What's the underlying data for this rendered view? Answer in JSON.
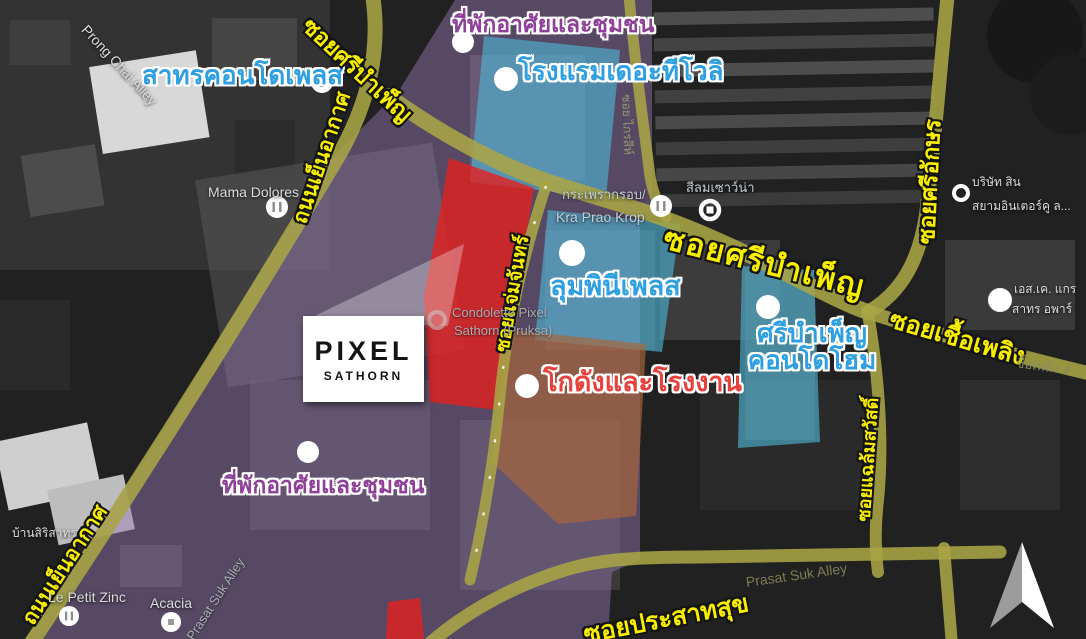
{
  "project_box": {
    "title": "PIXEL",
    "subtitle": "SATHORN"
  },
  "place_labels": {
    "sathorn_condo_place": "สาทรคอนโดเพลส",
    "residential_top": "ที่พักอาศัยและชุมชน",
    "tivoli_hotel": "โรงแรมเดอะทีโวลิ",
    "lumpini_place": "ลุมพินีเพลส",
    "sri_bamphen_condo_line1": "ศรีบำเพ็ญ",
    "sri_bamphen_condo_line2": "คอนโดโฮม",
    "warehouse_factory": "โกดังและโรงงาน",
    "residential_bottom": "ที่พักอาศัยและชุมชน"
  },
  "road_labels": {
    "sri_bamphen_nw": "ซอยศรีบำเพ็ญ",
    "sri_bamphen_e": "ซอยศรีบำเพ็ญ",
    "yen_akat_upper": "ถนนเย็นอากาศ",
    "yen_akat_lower": "ถนนเย็นอากาศ",
    "sri_akson": "ซอยศรีอักษร",
    "chuea_phloeng": "ซอยเชื้อเพลิง",
    "chaem_chan": "ซอยแจ่มจันทร์",
    "chalaem_sawat": "ซอยแฉล้มสวัสดิ์",
    "prasat_suk": "ซอยประสาทสุข"
  },
  "basemap_labels": {
    "prong_chai_alley": "Prong Chai Alley",
    "mama_dolores": "Mama Dolores",
    "kra_prao_line1": "กระเพรากรอบ/",
    "kra_prao_line2": "Kra Prao Krop",
    "silom_sauna": "สีลมเซาว์น่า",
    "company_line1": "บริษัท สิน",
    "company_line2": "สยามอินเตอร์คู ล...",
    "sk_line1": "เอส.เค. แกร",
    "sk_line2": "สาทร อพาร์",
    "chuea_phloeng_4": "ชื้อเพลิง 4",
    "baan_siri_sathorn": "บ้านสิริสาทร",
    "le_petit_zinc": "Le Petit Zinc",
    "acacia": "Acacia",
    "prasat_suk_alley_w": "Prasat Suk Alley",
    "prasat_suk_alley_e": "Prasat Suk Alley",
    "krai_si": "ซอย ไกรสีห์",
    "condolette_line1": "Condolette Pixel",
    "condolette_line2": "Sathorn (Pruksa)"
  },
  "colors": {
    "road_label_yellow": "#f8ef00",
    "condo_label_blue": "#2e9fe0",
    "residential_label_purple": "#8e3f98",
    "warehouse_label_red": "#e8403a",
    "zone_residential_purple": "#9a7ab5",
    "zone_condo_teal": "#4fb6d6",
    "zone_project_red": "#e3201e",
    "zone_warehouse_brown": "#a9663a",
    "road_fill": "#a8a545"
  }
}
